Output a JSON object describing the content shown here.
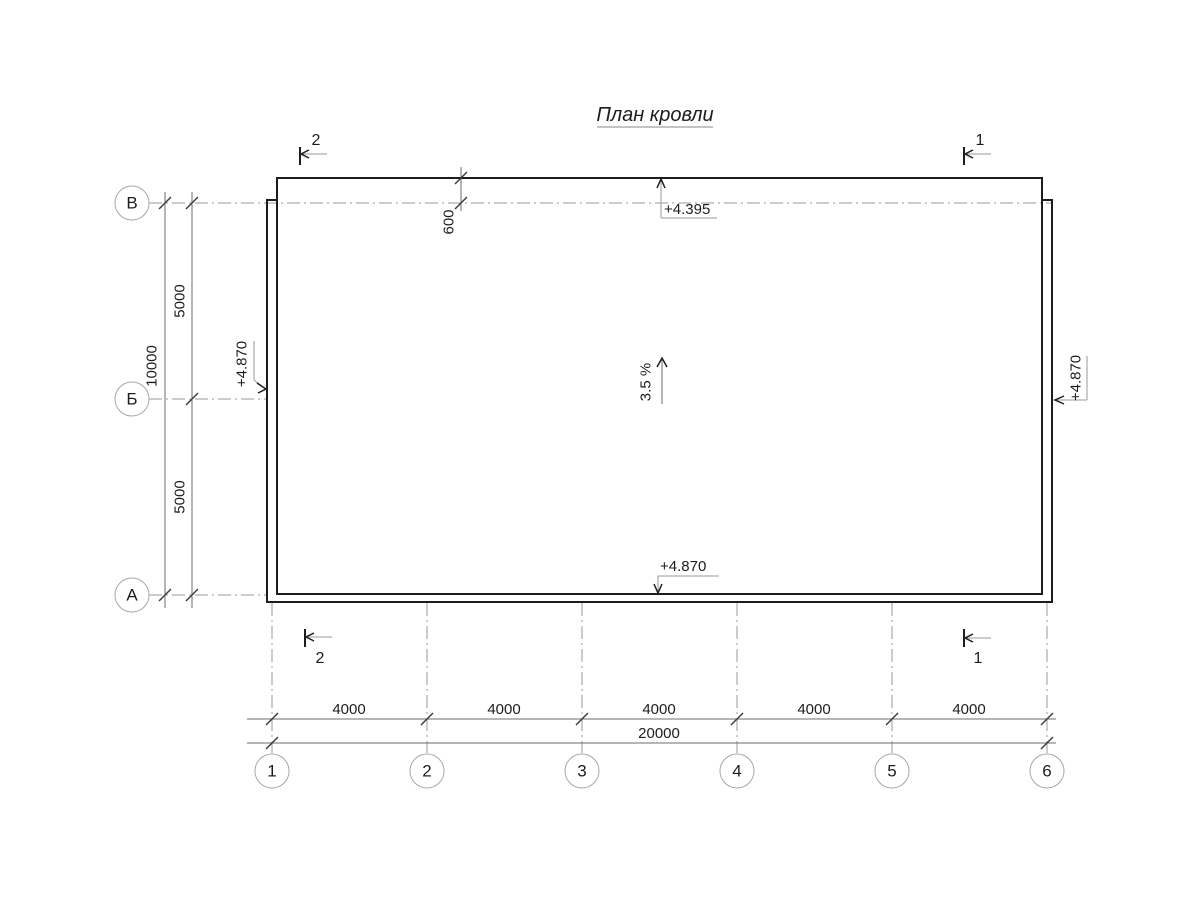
{
  "colors": {
    "line": "#1d1d1d",
    "axis_line": "#9a9a9a",
    "dimension_line": "#6e6e6e",
    "background": "#ffffff"
  },
  "title": {
    "text": "План кровли"
  },
  "roof": {
    "slope": "3.5 %",
    "elevation_top": "+4.395",
    "elevation_left": "+4.870",
    "elevation_right": "+4.870",
    "elevation_bottom": "+4.870",
    "eave_offset": "600"
  },
  "grid_axes": {
    "rows": [
      "В",
      "Б",
      "А"
    ],
    "columns": [
      "1",
      "2",
      "3",
      "4",
      "5",
      "6"
    ]
  },
  "dimensions": {
    "row_spacing": [
      "5000",
      "5000"
    ],
    "row_total": "10000",
    "column_spacing": [
      "4000",
      "4000",
      "4000",
      "4000",
      "4000"
    ],
    "column_total": "20000"
  },
  "sections": {
    "top_left": "2",
    "top_right": "1",
    "bottom_left": "2",
    "bottom_right": "1"
  }
}
